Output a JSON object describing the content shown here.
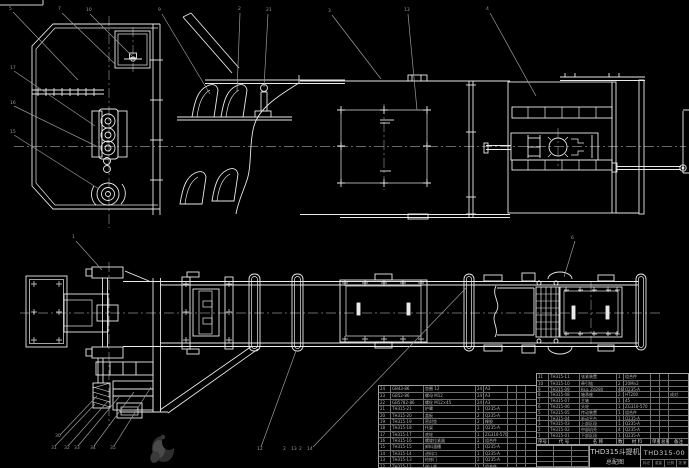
{
  "colors": {
    "background": "#000000",
    "drawing_line": "#e9e9e9",
    "annotation_gray": "#9a9a9a",
    "center_line": "#8a8a8a",
    "table_line": "#9f9f9f",
    "table_text": "#b9b9b9"
  },
  "title_block": {
    "drawing_name_line1": "THD315斗提机",
    "drawing_name_line2": "总配图",
    "drawing_number": "THD315-00",
    "footer_cells": [
      "标记",
      "重量",
      "比例",
      "共 张 第 张"
    ]
  },
  "bom_right": {
    "headers": [
      "序号",
      "代  号",
      "名  称",
      "数量",
      "材  料",
      "单重",
      "总重",
      "备注"
    ],
    "rows": [
      [
        "11",
        "TH315-11",
        "张紧装置",
        "1",
        "组合件",
        "",
        "",
        ""
      ],
      [
        "10",
        "TH315-10",
        "牵引链",
        "2",
        "20Mn2",
        "",
        "",
        ""
      ],
      [
        "9",
        "TH315-09",
        "料斗 Zd280",
        "46",
        "Q235-A",
        "",
        "",
        ""
      ],
      [
        "8",
        "TH315-08",
        "轴承座",
        "2",
        "HT200",
        "",
        "",
        "成对"
      ],
      [
        "7",
        "TH315-07",
        "主轴",
        "1",
        "45",
        "",
        "",
        ""
      ],
      [
        "6",
        "TH315-06",
        "头轮",
        "1",
        "ZG310-570",
        "",
        "",
        ""
      ],
      [
        "5",
        "TH315-05",
        "传动装置",
        "1",
        "组合件",
        "",
        "",
        ""
      ],
      [
        "4",
        "TH315-04",
        "驱动平台",
        "1",
        "Q235-A",
        "",
        "",
        ""
      ],
      [
        "3",
        "TH315-03",
        "上部区段",
        "1",
        "Q235-A",
        "",
        "",
        ""
      ],
      [
        "2",
        "TH315-02",
        "中部机壳",
        "4",
        "Q235-A",
        "",
        "",
        ""
      ],
      [
        "1",
        "TH315-01",
        "下部区段",
        "1",
        "Q235-A",
        "",
        "",
        ""
      ]
    ]
  },
  "bom_left": {
    "rows": [
      [
        "24",
        "GB43-86",
        "垫圈 12",
        "24",
        "A3",
        "",
        "",
        ""
      ],
      [
        "23",
        "GB52-86",
        "螺母 M12",
        "24",
        "A3",
        "",
        "",
        ""
      ],
      [
        "22",
        "GB5782-86",
        "螺栓 M12×45",
        "24",
        "A3",
        "",
        "",
        ""
      ],
      [
        "21",
        "TH315-21",
        "护罩",
        "1",
        "Q235-A",
        "",
        "",
        ""
      ],
      [
        "20",
        "TH315-20",
        "盖板",
        "2",
        "Q235-A",
        "",
        "",
        ""
      ],
      [
        "19",
        "TH315-19",
        "密封垫",
        "2",
        "橡胶",
        "",
        "",
        ""
      ],
      [
        "18",
        "TH315-18",
        "托架",
        "2",
        "Q235-A",
        "",
        "",
        ""
      ],
      [
        "17",
        "TH315-17",
        "底轮",
        "1",
        "ZG310-570",
        "",
        "",
        ""
      ],
      [
        "16",
        "TH315-16",
        "螺旋拉紧器",
        "2",
        "组合件",
        "",
        "",
        ""
      ],
      [
        "15",
        "TH315-15",
        "卸料溜槽",
        "1",
        "Q235-A",
        "",
        "",
        ""
      ],
      [
        "14",
        "TH315-14",
        "进料口",
        "1",
        "Q235-A",
        "",
        "",
        ""
      ],
      [
        "13",
        "TH315-13",
        "检修门",
        "2",
        "Q235-A",
        "",
        "",
        ""
      ],
      [
        "12",
        "TH315-12",
        "逆止器",
        "1",
        "组合件",
        "",
        "",
        ""
      ]
    ]
  },
  "callouts": [
    {
      "x": 9,
      "y": 10,
      "label": "5"
    },
    {
      "x": 58,
      "y": 10,
      "label": "7"
    },
    {
      "x": 86,
      "y": 11,
      "label": "10"
    },
    {
      "x": 158,
      "y": 11,
      "label": "9"
    },
    {
      "x": 238,
      "y": 10,
      "label": "2"
    },
    {
      "x": 266,
      "y": 11,
      "label": "21"
    },
    {
      "x": 328,
      "y": 12,
      "label": "3"
    },
    {
      "x": 404,
      "y": 11,
      "label": "13"
    },
    {
      "x": 486,
      "y": 10,
      "label": "4"
    },
    {
      "x": 10,
      "y": 69,
      "label": "17"
    },
    {
      "x": 10,
      "y": 104,
      "label": "16"
    },
    {
      "x": 10,
      "y": 133,
      "label": "15"
    },
    {
      "x": 72,
      "y": 238,
      "label": "1"
    },
    {
      "x": 571,
      "y": 239,
      "label": "6"
    },
    {
      "x": 55,
      "y": 437,
      "label": "30"
    },
    {
      "x": 51,
      "y": 449,
      "label": "31"
    },
    {
      "x": 64,
      "y": 449,
      "label": "32"
    },
    {
      "x": 74,
      "y": 449,
      "label": "33"
    },
    {
      "x": 90,
      "y": 449,
      "label": "34"
    },
    {
      "x": 110,
      "y": 449,
      "label": "35"
    },
    {
      "x": 257,
      "y": 450,
      "label": "12"
    },
    {
      "x": 283,
      "y": 450,
      "label": "2"
    },
    {
      "x": 291,
      "y": 450,
      "label": "13"
    },
    {
      "x": 299,
      "y": 450,
      "label": "2"
    },
    {
      "x": 307,
      "y": 450,
      "label": "14"
    }
  ]
}
